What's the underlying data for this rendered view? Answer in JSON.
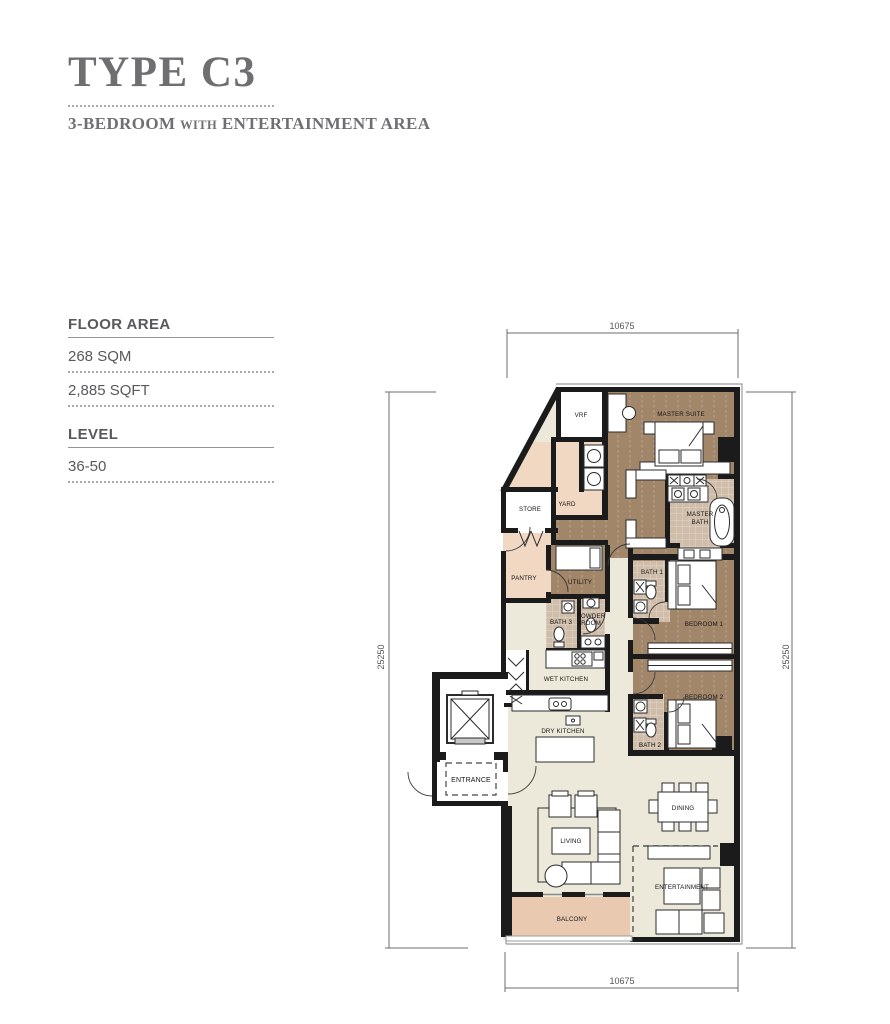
{
  "page": {
    "title": "TYPE C3"
  },
  "subtitle": {
    "part1": "3-BEDROOM",
    "connector": "with",
    "part2": "ENTERTAINMENT AREA"
  },
  "specs": {
    "floor_area_label": "FLOOR AREA",
    "area_sqm": "268 SQM",
    "area_sqft": "2,885 SQFT",
    "level_label": "LEVEL",
    "level_value": "36-50"
  },
  "dimensions": {
    "top": "10675",
    "bottom": "10675",
    "left": "25250",
    "right": "25250"
  },
  "rooms": {
    "vrf": "VRF",
    "master_suite": "MASTER SUITE",
    "store": "STORE",
    "yard": "YARD",
    "master_bath": {
      "line1": "MASTER",
      "line2": "BATH"
    },
    "pantry": "PANTRY",
    "utility": "UTILITY",
    "bath3": "BATH 3",
    "powder_room": {
      "line1": "POWDER",
      "line2": "ROOM"
    },
    "bath1": "BATH 1",
    "bedroom1": "BEDROOM 1",
    "wet_kitchen": "WET KITCHEN",
    "bedroom2": "BEDROOM 2",
    "bath2": "BATH 2",
    "dry_kitchen": "DRY KITCHEN",
    "entrance": "ENTRANCE",
    "dining": "DINING",
    "living": "LIVING",
    "entertainment": "ENTERTAINMENT",
    "balcony": "BALCONY"
  },
  "colors": {
    "heading_gray": "#6e6f71",
    "text_gray": "#58595b",
    "wall_black": "#1b1b1b",
    "room_brown": "#a28669",
    "bath_tile": "#cfbda9",
    "service_peach": "#f0d8c3",
    "floor_cream": "#ece9da",
    "balcony_pink": "#e9c9b0",
    "dim_gray": "#6d6d6d"
  }
}
